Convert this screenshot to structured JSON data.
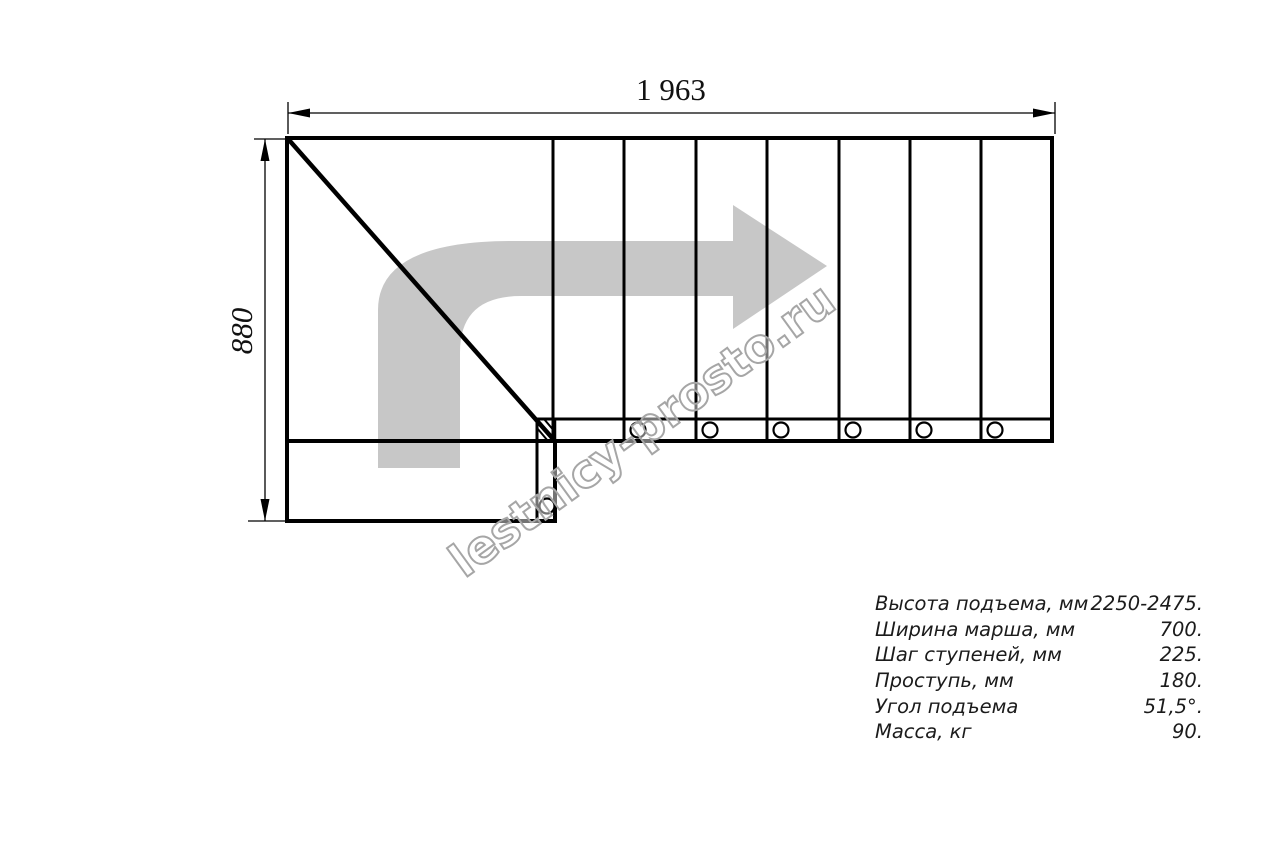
{
  "drawing": {
    "type": "staircase-plan",
    "top_dimension": "1 963",
    "left_dimension": "880",
    "watermark": "lestnicy-prosto.ru",
    "tread_count": 7,
    "direction_arrow": "turn-right-arrow"
  },
  "specs": {
    "rows": [
      {
        "label": "Высота подъема, мм",
        "value": "2250-2475."
      },
      {
        "label": "Ширина марша, мм",
        "value": "700."
      },
      {
        "label": "Шаг ступеней, мм",
        "value": "225."
      },
      {
        "label": "Проступь, мм",
        "value": "180."
      },
      {
        "label": "Угол подъема",
        "value": "51,5°."
      },
      {
        "label": "Масса, кг",
        "value": "90."
      }
    ]
  },
  "colors": {
    "line": "#000000",
    "arrow_fill": "#c7c7c7",
    "watermark_outline": "#a6a6a6",
    "background": "#ffffff"
  }
}
